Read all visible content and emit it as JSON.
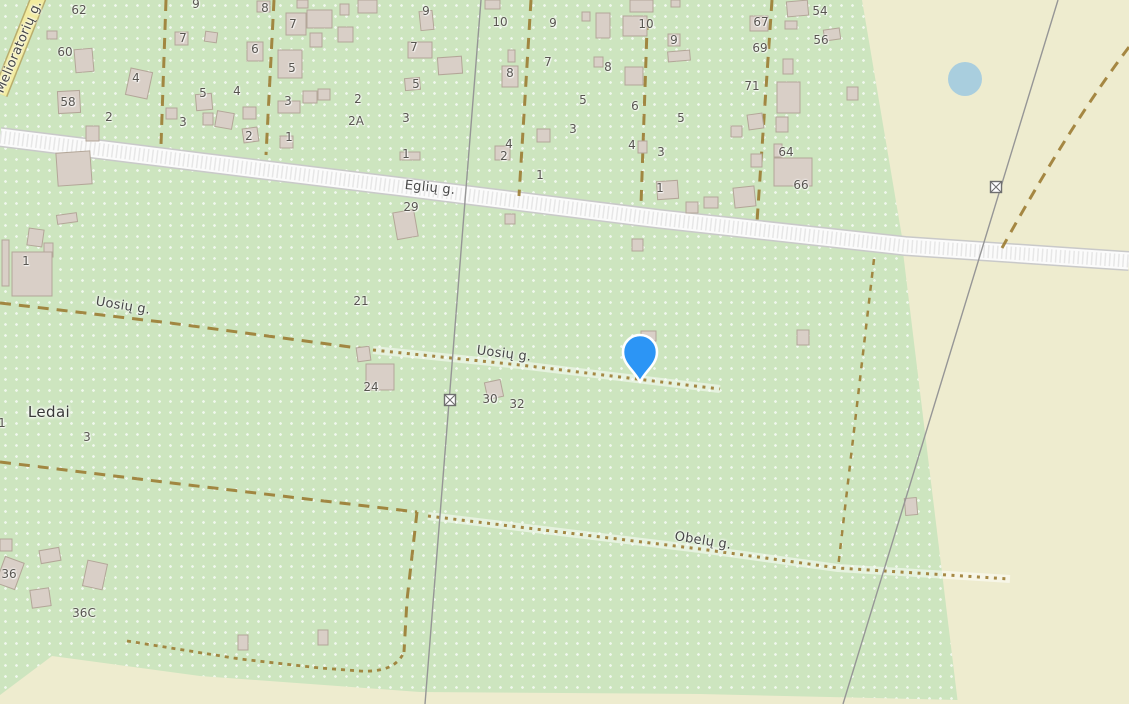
{
  "map": {
    "place_labels": [
      {
        "text": "Ledai",
        "x": 49,
        "y": 412,
        "rotate": 0
      }
    ],
    "street_labels": [
      {
        "text": "Melioratorių g.",
        "x": 19,
        "y": 47,
        "rotate": -67
      },
      {
        "text": "Eglių g.",
        "x": 430,
        "y": 188,
        "rotate": 6
      },
      {
        "text": "Uosių g.",
        "x": 123,
        "y": 306,
        "rotate": 9
      },
      {
        "text": "Uosių g.",
        "x": 504,
        "y": 354,
        "rotate": 7
      },
      {
        "text": "Obelų g.",
        "x": 703,
        "y": 541,
        "rotate": 9
      }
    ],
    "house_numbers": [
      {
        "text": "62",
        "x": 79,
        "y": 10
      },
      {
        "text": "60",
        "x": 65,
        "y": 52
      },
      {
        "text": "58",
        "x": 68,
        "y": 102
      },
      {
        "text": "7",
        "x": 183,
        "y": 38
      },
      {
        "text": "4",
        "x": 136,
        "y": 78
      },
      {
        "text": "2",
        "x": 109,
        "y": 117
      },
      {
        "text": "3",
        "x": 183,
        "y": 122
      },
      {
        "text": "9",
        "x": 196,
        "y": 4
      },
      {
        "text": "5",
        "x": 203,
        "y": 93
      },
      {
        "text": "4",
        "x": 237,
        "y": 91
      },
      {
        "text": "6",
        "x": 255,
        "y": 49
      },
      {
        "text": "8",
        "x": 265,
        "y": 8
      },
      {
        "text": "2",
        "x": 249,
        "y": 136
      },
      {
        "text": "7",
        "x": 293,
        "y": 24
      },
      {
        "text": "5",
        "x": 292,
        "y": 68
      },
      {
        "text": "3",
        "x": 288,
        "y": 101
      },
      {
        "text": "2",
        "x": 358,
        "y": 99
      },
      {
        "text": "2A",
        "x": 356,
        "y": 121
      },
      {
        "text": "1",
        "x": 289,
        "y": 137
      },
      {
        "text": "9",
        "x": 426,
        "y": 11
      },
      {
        "text": "10",
        "x": 500,
        "y": 22
      },
      {
        "text": "7",
        "x": 414,
        "y": 47
      },
      {
        "text": "5",
        "x": 416,
        "y": 84
      },
      {
        "text": "3",
        "x": 406,
        "y": 118
      },
      {
        "text": "1",
        "x": 406,
        "y": 154
      },
      {
        "text": "8",
        "x": 510,
        "y": 73
      },
      {
        "text": "4",
        "x": 509,
        "y": 144
      },
      {
        "text": "2",
        "x": 504,
        "y": 156
      },
      {
        "text": "9",
        "x": 553,
        "y": 23
      },
      {
        "text": "10",
        "x": 646,
        "y": 24
      },
      {
        "text": "7",
        "x": 548,
        "y": 62
      },
      {
        "text": "8",
        "x": 608,
        "y": 67
      },
      {
        "text": "5",
        "x": 583,
        "y": 100
      },
      {
        "text": "6",
        "x": 635,
        "y": 106
      },
      {
        "text": "3",
        "x": 573,
        "y": 129
      },
      {
        "text": "4",
        "x": 632,
        "y": 145
      },
      {
        "text": "67",
        "x": 761,
        "y": 22
      },
      {
        "text": "69",
        "x": 760,
        "y": 48
      },
      {
        "text": "54",
        "x": 820,
        "y": 11
      },
      {
        "text": "56",
        "x": 821,
        "y": 40
      },
      {
        "text": "9",
        "x": 674,
        "y": 40
      },
      {
        "text": "71",
        "x": 752,
        "y": 86
      },
      {
        "text": "5",
        "x": 681,
        "y": 118
      },
      {
        "text": "3",
        "x": 661,
        "y": 152
      },
      {
        "text": "64",
        "x": 786,
        "y": 152
      },
      {
        "text": "1",
        "x": 660,
        "y": 188
      },
      {
        "text": "66",
        "x": 801,
        "y": 185
      },
      {
        "text": "29",
        "x": 411,
        "y": 207
      },
      {
        "text": "1",
        "x": 540,
        "y": 175
      },
      {
        "text": "21",
        "x": 361,
        "y": 301
      },
      {
        "text": "24",
        "x": 371,
        "y": 387
      },
      {
        "text": "30",
        "x": 490,
        "y": 399
      },
      {
        "text": "32",
        "x": 517,
        "y": 404
      },
      {
        "text": "1",
        "x": 26,
        "y": 261
      },
      {
        "text": "3",
        "x": 87,
        "y": 437
      },
      {
        "text": "1",
        "x": 2,
        "y": 423
      },
      {
        "text": "36",
        "x": 9,
        "y": 574
      },
      {
        "text": "36C",
        "x": 84,
        "y": 613
      }
    ],
    "buildings": [
      [
        47,
        31,
        10,
        8,
        0
      ],
      [
        175,
        32,
        13,
        13,
        0
      ],
      [
        205,
        32,
        12,
        10,
        8
      ],
      [
        75,
        49,
        18,
        23,
        -5
      ],
      [
        128,
        70,
        22,
        27,
        12
      ],
      [
        58,
        91,
        22,
        22,
        -3
      ],
      [
        86,
        126,
        13,
        15,
        0
      ],
      [
        166,
        108,
        11,
        11,
        0
      ],
      [
        196,
        94,
        16,
        16,
        -5
      ],
      [
        203,
        113,
        10,
        12,
        0
      ],
      [
        216,
        112,
        17,
        16,
        10
      ],
      [
        243,
        107,
        13,
        12,
        0
      ],
      [
        243,
        128,
        15,
        14,
        -8
      ],
      [
        257,
        1,
        13,
        11,
        0
      ],
      [
        247,
        42,
        16,
        19,
        0
      ],
      [
        286,
        13,
        20,
        22,
        0
      ],
      [
        307,
        10,
        25,
        18,
        0
      ],
      [
        310,
        33,
        12,
        14,
        0
      ],
      [
        338,
        27,
        15,
        15,
        0
      ],
      [
        278,
        50,
        24,
        28,
        0
      ],
      [
        278,
        101,
        22,
        12,
        0
      ],
      [
        303,
        91,
        14,
        12,
        0
      ],
      [
        318,
        89,
        12,
        11,
        0
      ],
      [
        280,
        136,
        13,
        12,
        0
      ],
      [
        297,
        0,
        11,
        8,
        0
      ],
      [
        340,
        4,
        9,
        11,
        0
      ],
      [
        358,
        0,
        19,
        13,
        0
      ],
      [
        420,
        11,
        13,
        19,
        -6
      ],
      [
        408,
        42,
        24,
        16,
        0
      ],
      [
        438,
        57,
        24,
        17,
        -4
      ],
      [
        405,
        78,
        15,
        12,
        -5
      ],
      [
        502,
        66,
        16,
        21,
        0
      ],
      [
        508,
        50,
        7,
        12,
        0
      ],
      [
        400,
        152,
        20,
        8,
        0
      ],
      [
        495,
        146,
        15,
        14,
        0
      ],
      [
        485,
        0,
        15,
        9,
        0
      ],
      [
        582,
        12,
        8,
        9,
        0
      ],
      [
        596,
        13,
        14,
        25,
        0
      ],
      [
        594,
        57,
        9,
        10,
        0
      ],
      [
        623,
        16,
        24,
        20,
        0
      ],
      [
        625,
        67,
        18,
        18,
        0
      ],
      [
        537,
        129,
        13,
        13,
        0
      ],
      [
        630,
        0,
        23,
        12,
        0
      ],
      [
        638,
        141,
        9,
        12,
        0
      ],
      [
        750,
        16,
        18,
        15,
        0
      ],
      [
        787,
        1,
        21,
        15,
        -5
      ],
      [
        785,
        21,
        12,
        8,
        0
      ],
      [
        824,
        29,
        16,
        11,
        -8
      ],
      [
        668,
        34,
        12,
        12,
        0
      ],
      [
        668,
        51,
        22,
        10,
        -5
      ],
      [
        783,
        59,
        10,
        15,
        0
      ],
      [
        777,
        82,
        23,
        31,
        0
      ],
      [
        847,
        87,
        11,
        13,
        0
      ],
      [
        748,
        114,
        15,
        15,
        -8
      ],
      [
        731,
        126,
        11,
        11,
        0
      ],
      [
        776,
        117,
        12,
        15,
        0
      ],
      [
        774,
        144,
        8,
        13,
        0
      ],
      [
        774,
        158,
        38,
        28,
        0
      ],
      [
        751,
        154,
        11,
        13,
        0
      ],
      [
        657,
        181,
        21,
        18,
        -4
      ],
      [
        734,
        187,
        21,
        20,
        -6
      ],
      [
        704,
        197,
        14,
        11,
        0
      ],
      [
        686,
        202,
        12,
        11,
        0
      ],
      [
        671,
        0,
        9,
        7,
        0
      ],
      [
        395,
        211,
        21,
        27,
        -10
      ],
      [
        505,
        214,
        10,
        10,
        0
      ],
      [
        632,
        239,
        11,
        12,
        0
      ],
      [
        57,
        152,
        34,
        33,
        -4
      ],
      [
        28,
        229,
        15,
        17,
        8
      ],
      [
        44,
        243,
        9,
        14,
        0
      ],
      [
        12,
        252,
        40,
        44,
        0
      ],
      [
        2,
        240,
        7,
        46,
        0
      ],
      [
        57,
        214,
        20,
        9,
        -8
      ],
      [
        641,
        331,
        15,
        10,
        0
      ],
      [
        797,
        330,
        12,
        15,
        0
      ],
      [
        357,
        347,
        13,
        14,
        -8
      ],
      [
        366,
        364,
        28,
        26,
        0
      ],
      [
        486,
        381,
        16,
        17,
        -12
      ],
      [
        905,
        498,
        12,
        17,
        -5
      ],
      [
        0,
        559,
        20,
        28,
        20
      ],
      [
        40,
        549,
        20,
        13,
        -10
      ],
      [
        31,
        589,
        19,
        18,
        -8
      ],
      [
        85,
        562,
        20,
        26,
        12
      ],
      [
        0,
        539,
        12,
        12,
        0
      ],
      [
        238,
        635,
        10,
        15,
        0
      ],
      [
        318,
        630,
        10,
        15,
        0
      ]
    ],
    "marker": {
      "x": 640,
      "y": 382
    },
    "pond": {
      "x": 965,
      "y": 79,
      "r": 17
    },
    "colors": {
      "greenery": "#cde5bf",
      "farmland": "#eeeccf",
      "road_yellow": "#f2eb9d",
      "road_yellow_casing": "#b9ad6d",
      "road_white": "#fbfbfb",
      "road_white_casing": "#c9c9c9",
      "track": "#9c7c33",
      "building": "#d9cfc7",
      "building_outline": "#b3a698",
      "power_line": "#969696",
      "water": "#a9cede",
      "marker_blue": "#2c95f5",
      "label_gray": "#585550"
    }
  }
}
